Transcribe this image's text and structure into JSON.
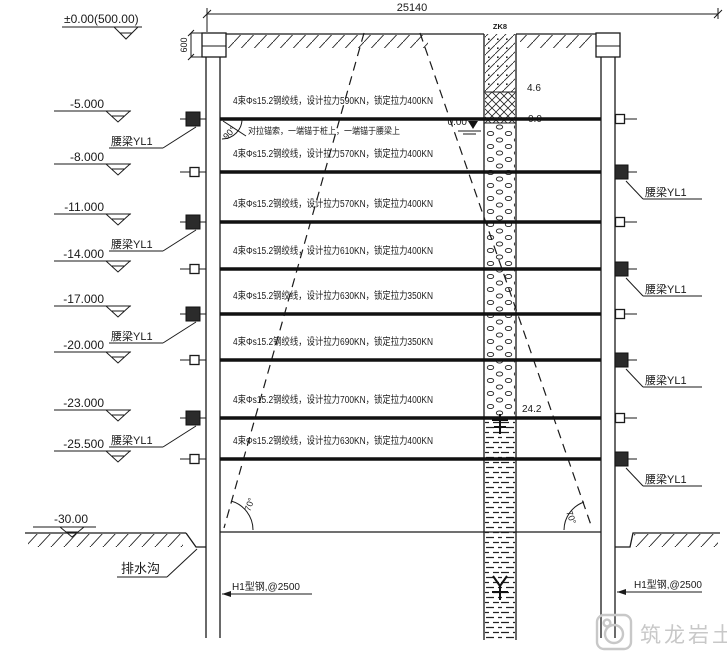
{
  "drawing": {
    "top_dimension": "25140",
    "datum_label": "±0.00(500.00)",
    "crown_dim": "600",
    "borehole_id": "ZK8",
    "depth_fill": "4.6",
    "water_level_left": "0.00",
    "water_level_right": "0.0",
    "depth_gravel": "24.2",
    "angle_top": "90°",
    "angle_left": "70°",
    "angle_right": "70°",
    "base_level": "-30.00",
    "ditch_label": "排水沟",
    "pile_label_left": "H1型钢,@2500",
    "pile_label_right": "H1型钢,@2500",
    "waler_label": "腰梁YL1",
    "note": "对拉锚索，一端锚于桩上，一端锚于腰梁上"
  },
  "levels": [
    "-5.000",
    "-8.000",
    "-11.000",
    "-14.000",
    "-17.000",
    "-20.000",
    "-23.000",
    "-25.500"
  ],
  "anchors": [
    {
      "spec": "4束Φs15.2钢绞线，设计拉力590KN，锁定拉力400KN"
    },
    {
      "spec": "4束Φs15.2钢绞线，设计拉力570KN，锁定拉力400KN"
    },
    {
      "spec": "4束Φs15.2钢绞线，设计拉力570KN，锁定拉力400KN"
    },
    {
      "spec": "4束Φs15.2钢绞线，设计拉力610KN，锁定拉力400KN"
    },
    {
      "spec": "4束Φs15.2钢绞线，设计拉力630KN，锁定拉力350KN"
    },
    {
      "spec": "4束Φs15.2钢绞线，设计拉力690KN，锁定拉力350KN"
    },
    {
      "spec": "4束Φs15.2钢绞线，设计拉力700KN，锁定拉力400KN"
    },
    {
      "spec": "4束Φs15.2钢绞线，设计拉力630KN，锁定拉力400KN"
    }
  ],
  "watermark": {
    "text": "筑龙岩土"
  },
  "colors": {
    "line": "#1a1a1a",
    "watermark": "#c8c8c8"
  }
}
